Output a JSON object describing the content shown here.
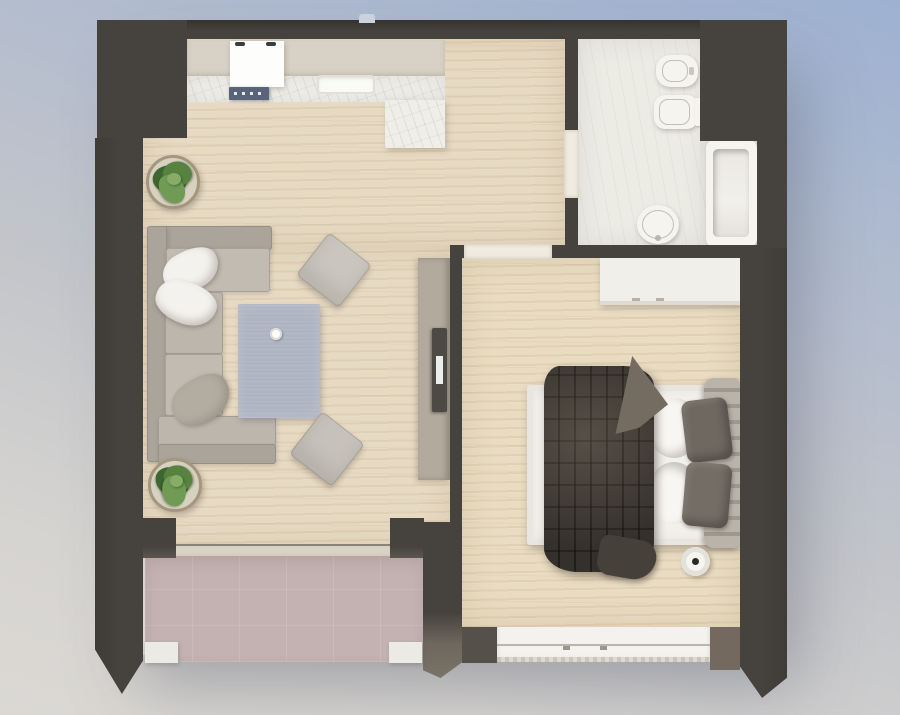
{
  "scene": {
    "type": "3d-floor-plan-top-view",
    "description": "Rendered top-down 3D floor plan of a one-bedroom apartment with open living/kitchen area, bedroom, bathroom and balcony"
  },
  "rooms": [
    {
      "id": "living-room",
      "name": "Living room"
    },
    {
      "id": "kitchen",
      "name": "Kitchen"
    },
    {
      "id": "bedroom",
      "name": "Bedroom"
    },
    {
      "id": "bathroom",
      "name": "Bathroom"
    },
    {
      "id": "balcony",
      "name": "Balcony"
    }
  ],
  "furniture": {
    "kitchen": [
      "counter",
      "marble-backsplash",
      "marble-cabinet",
      "stove",
      "cooktop",
      "sink"
    ],
    "living_room": [
      "corner-sofa",
      "white-pillow",
      "white-pillow",
      "gray-pillow",
      "rug",
      "coffee-cup",
      "ottoman-pouf",
      "ottoman-pouf",
      "potted-plant",
      "potted-plant",
      "tv-console",
      "tv"
    ],
    "bathroom": [
      "bidet",
      "toilet",
      "bathtub",
      "washbasin"
    ],
    "bedroom": [
      "wardrobe",
      "double-bed",
      "headboard",
      "dark-blanket",
      "bed-pillows",
      "white-sheets",
      "round-stool"
    ],
    "balcony": [
      "sliding-door",
      "parapet"
    ]
  },
  "palette": {
    "wall": "#46423d",
    "wall-dark": "#3b3835",
    "wall-lit": "#73695f",
    "wood": "#e7dac3",
    "wood2": "#e9dcc2",
    "marble": "#f0eee8",
    "bathfloor": "#ecebe4",
    "balcony": "#c3b2b1",
    "fixture": "#f6f4ef",
    "threshold": "#f0ebe1",
    "counter": "#d8d1c5",
    "cooktop": "#5a6478",
    "rug": "#aeb5c2",
    "sofa": "#aba49b",
    "sofa-light": "#c2bbb2",
    "pillow-white": "#f4f2ee",
    "pillow-gray": "#b3aca1",
    "pouf": "#cac6bf",
    "pot": "#d7d1c0",
    "pot-rim": "#a5977e",
    "plant-dark": "#3f6630",
    "plant-mid": "#57823f",
    "plant-light": "#6f9b54",
    "console": "#b3aa9e",
    "tv": "#4d4944",
    "bed-white": "#f3f1ec",
    "headboard": "#b9b3aa",
    "blanket": "#46403a",
    "bed-pillow": "#6f6860",
    "stool-dot": "#2c2824"
  }
}
